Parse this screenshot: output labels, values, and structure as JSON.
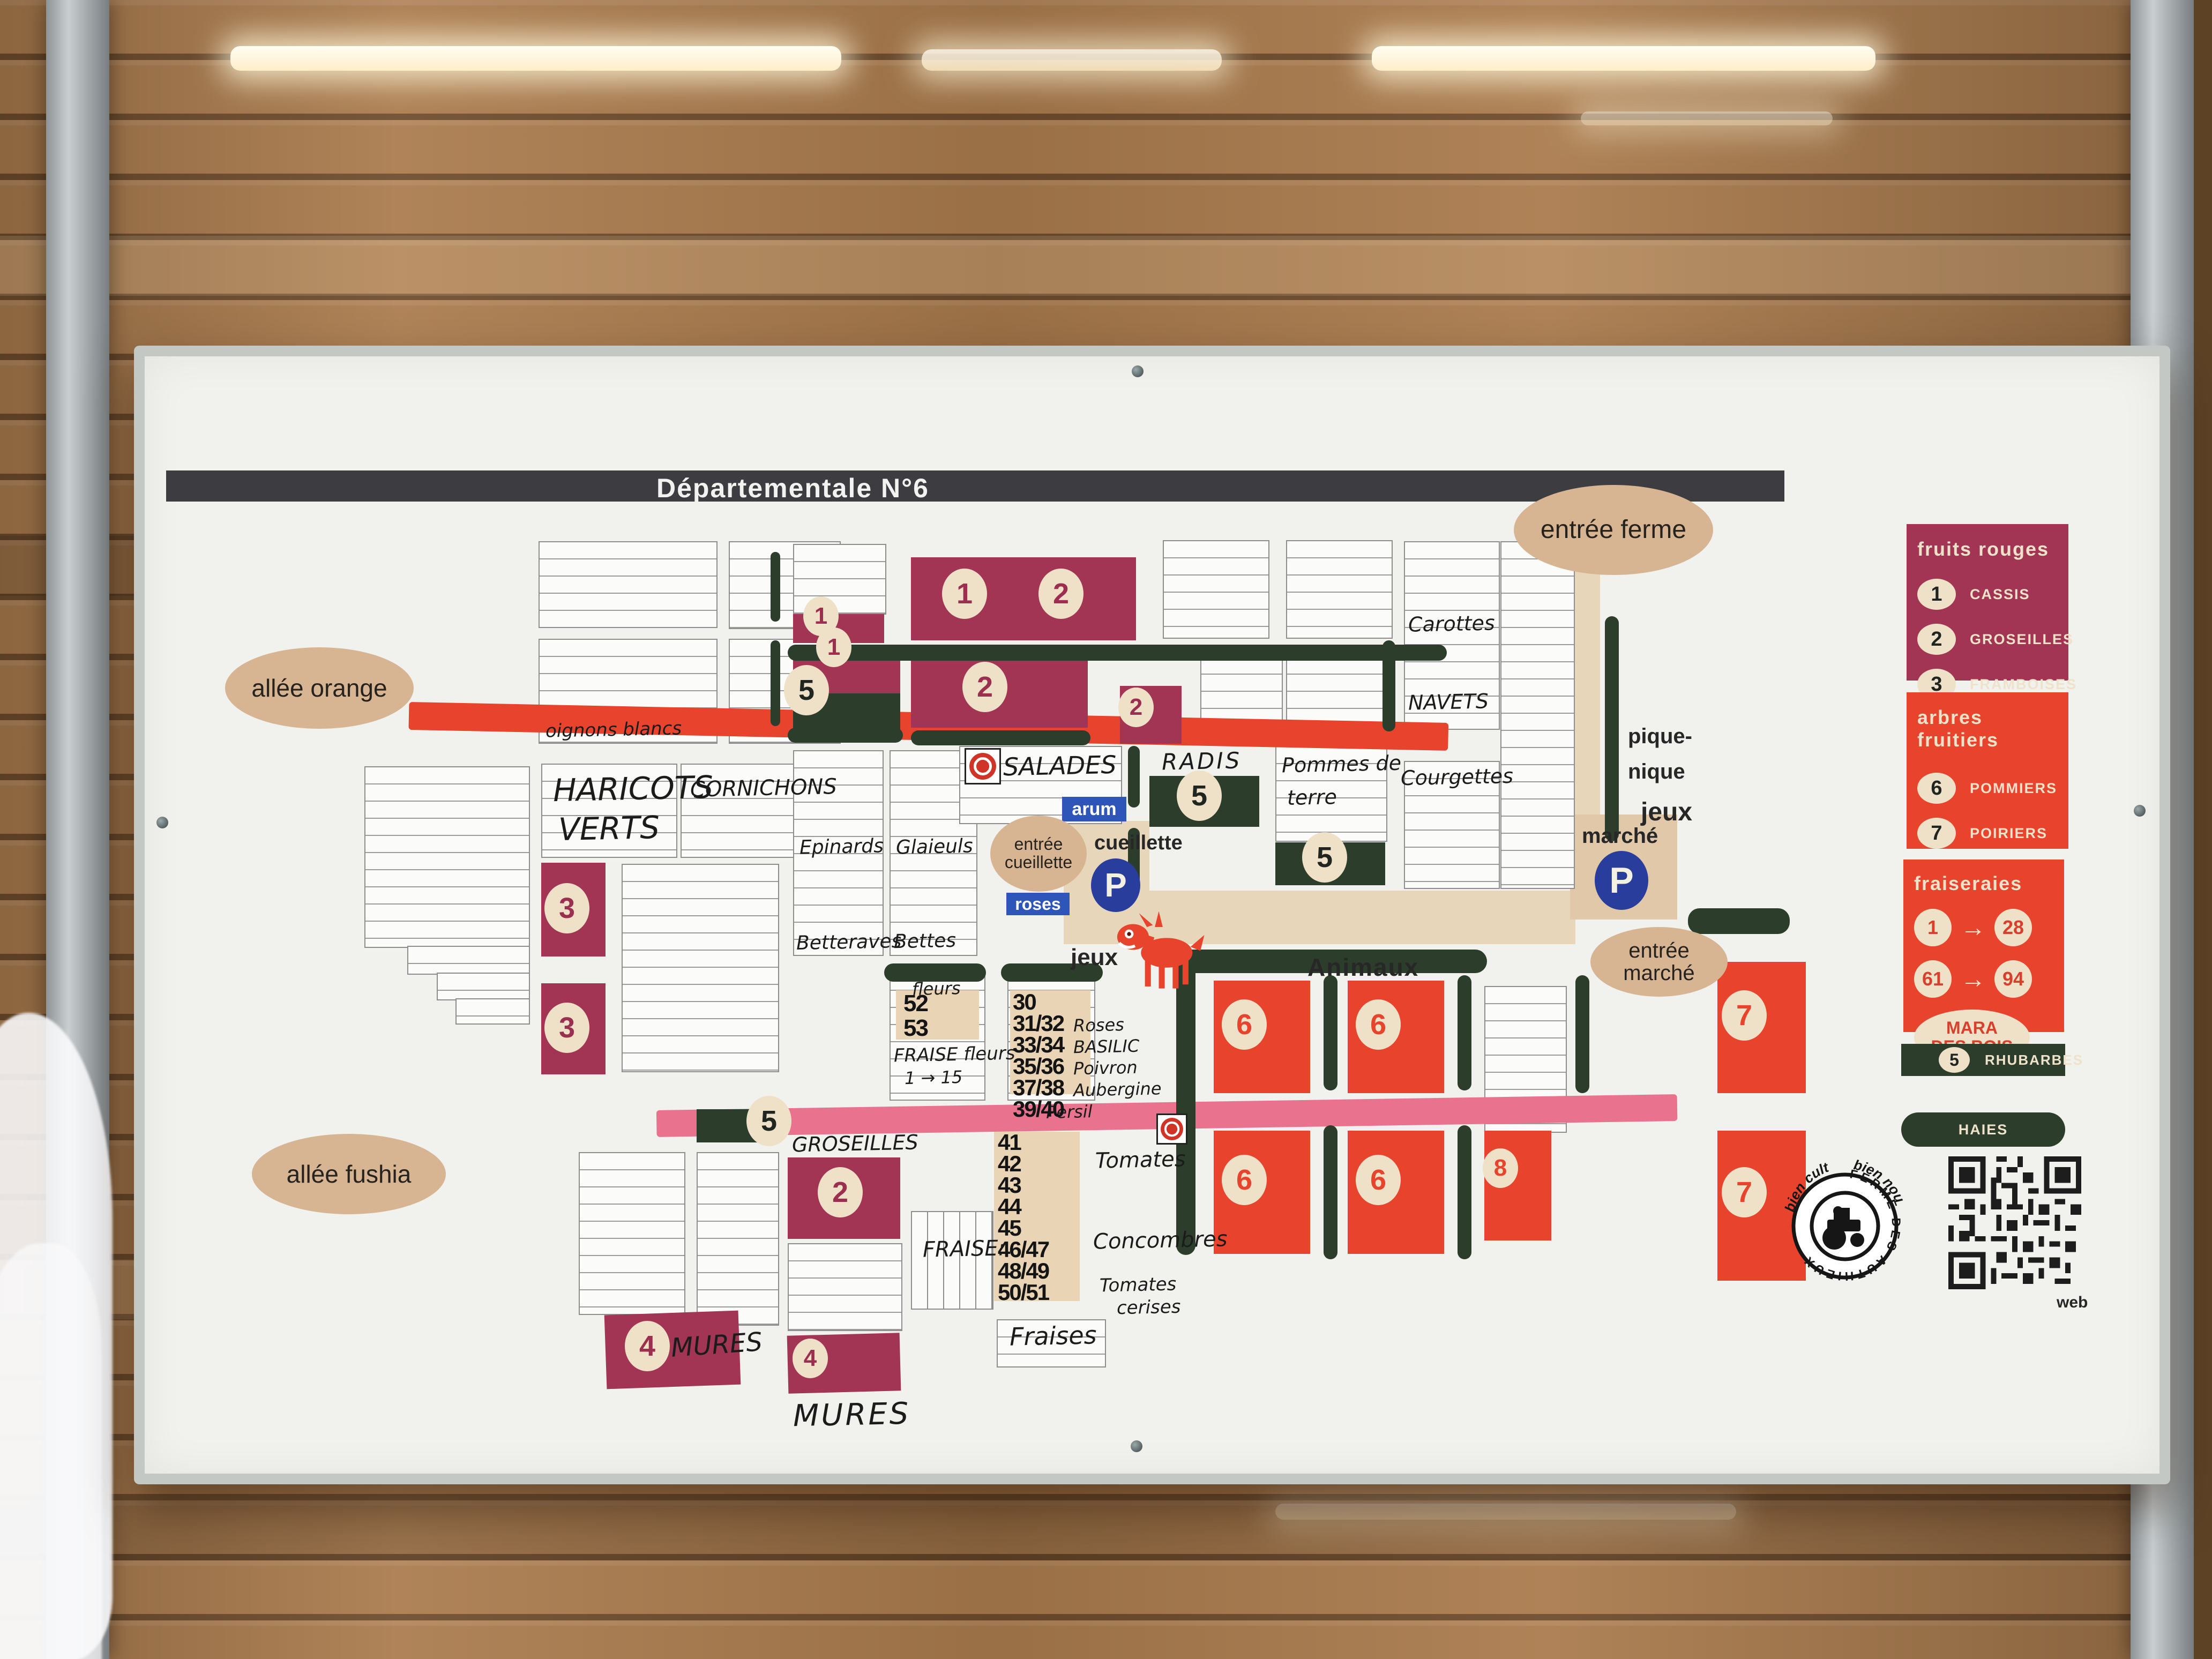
{
  "header": {
    "title": "Départementale N°6"
  },
  "entrances": {
    "ferme": "entrée ferme",
    "cueillette_line1": "entrée",
    "cueillette_line2": "cueillette",
    "marche_line1": "entrée",
    "marche_line2": "marché"
  },
  "allees": {
    "orange": "allée orange",
    "fushia": "allée fushia"
  },
  "labels": {
    "animaux": "Animaux",
    "jeux_road": "jeux",
    "jeux_picnic": "jeux",
    "pique_line1": "pique-",
    "pique_line2": "nique",
    "cueillette_road": "cueillette",
    "marche_parking": "marché",
    "arum": "arum",
    "roses": "roses",
    "parking_symbol": "P"
  },
  "legend": {
    "fruits_rouges": {
      "title": "fruits rouges",
      "items": [
        {
          "num": "1",
          "label": "CASSIS"
        },
        {
          "num": "2",
          "label": "GROSEILLES"
        },
        {
          "num": "3",
          "label": "FRAMBOISES"
        },
        {
          "num": "4",
          "label": "MURES"
        }
      ]
    },
    "arbres_fruitiers": {
      "title": "arbres fruitiers",
      "items": [
        {
          "num": "6",
          "label": "POMMIERS"
        },
        {
          "num": "7",
          "label": "POIRIERS"
        },
        {
          "num": "8",
          "label": "PRUNIERS"
        }
      ]
    },
    "fraiseraies": {
      "title": "fraiseraies",
      "arrow": "→",
      "ranges": [
        {
          "from": "1",
          "to": "28"
        },
        {
          "from": "61",
          "to": "94"
        }
      ],
      "variety_line1": "MARA",
      "variety_line2": "DES BOIS"
    },
    "rhubarbes": {
      "num": "5",
      "label": "RHUBARBES"
    },
    "haies": {
      "label": "HAIES"
    }
  },
  "logo": {
    "arc_left": "bien cultivé",
    "arc_right": "bien nourri",
    "ring_text": "FERME DES AUTHIEUX",
    "qr_caption": "web"
  },
  "hand": {
    "haricots_line1": "HARICOTS",
    "haricots_line2": "VERTS",
    "cornichons": "CORNICHONS",
    "oignons_blancs": "oignons blancs",
    "epinards": "Epinards",
    "glaieuls": "Glaieuls",
    "betteraves": "Betteraves",
    "bettes": "Bettes",
    "salades": "SALADES",
    "radis": "RADIS",
    "pommes_line1": "Pommes de",
    "pommes_line2": "terre",
    "courgettes": "Courgettes",
    "carottes": "Carottes",
    "navets": "NAVETS",
    "groseilles": "GROSEILLES",
    "mures_left": "MURES",
    "mures_mid": "MURES",
    "fleurs": "fleurs",
    "fraise_fleurs": "FRAISE fleurs",
    "fraise_range": "1 → 15",
    "persil": "Persil",
    "tomates": "Tomates",
    "concombres": "Concombres",
    "cerises_line1": "Tomates",
    "cerises_line2": "cerises",
    "fraise_colon": "FRAISE:",
    "fraises": "Fraises"
  },
  "col_fleurs": {
    "rows": [
      "52",
      "53"
    ]
  },
  "col_trente": {
    "rows": [
      "30",
      "31/32",
      "33/34",
      "35/36",
      "37/38",
      "39/40"
    ],
    "ann": [
      "",
      "Roses",
      "BASILIC",
      "Poivron",
      "Aubergine",
      ""
    ]
  },
  "col_quarante": {
    "rows": [
      "41",
      "42",
      "43",
      "44",
      "45",
      "46/47",
      "48/49",
      "50/51"
    ]
  },
  "plots": {
    "strip_cassis": "1",
    "big_cassis": "1",
    "big_groseille": "2",
    "split_cassis": "1",
    "split_rhubarbe": "5",
    "mid_groseille": "2",
    "small_groseille": "2",
    "framboise_upper": "3",
    "framboise_lower": "3",
    "radis_rhubarbe": "5",
    "pdt_rhubarbe": "5",
    "fushia_rhubarbe": "5",
    "south_groseille": "2",
    "mure_left": "4",
    "mure_mid": "4",
    "pommier_1a": "6",
    "pommier_1b": "6",
    "poirier_1": "7",
    "pommier_2a": "6",
    "pommier_2b": "6",
    "prunier_2": "8",
    "poirier_2": "7"
  },
  "colors": {
    "crimson": "#a23554",
    "orange": "#e8432c",
    "green": "#2c3d2b",
    "tan_oval": "#d8b592",
    "road": "#e7d6ba",
    "pink": "#e9738f",
    "blue_parking": "#293e9c",
    "blue_label": "#2e56b8"
  }
}
